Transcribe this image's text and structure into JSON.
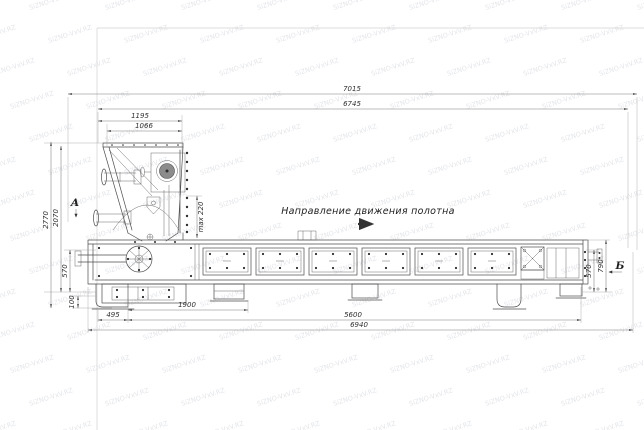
{
  "drawing": {
    "labels": {
      "direction": "Направление движения полотна",
      "view_a": "А",
      "view_b": "Б"
    },
    "dims": {
      "total_length": "7015",
      "frame_length": "6745",
      "hopper_len_outer": "1195",
      "hopper_len_inner": "1066",
      "height_total": "2770",
      "height_hopper": "2070",
      "height_frame_left": "570",
      "gap_max": "max 220",
      "foot_height": "100",
      "offset_left": "495",
      "head_length": "1900",
      "body_length": "5600",
      "base_length": "6940",
      "height_frame_right": "570",
      "height_tail": "790"
    },
    "watermark_text": "SiZNO-VxV.RZ",
    "colors": {
      "line": "#4d4d4d",
      "dim_line": "#7c7c7c",
      "text": "#2f2f2f",
      "watermark": "#a9afbc"
    }
  }
}
